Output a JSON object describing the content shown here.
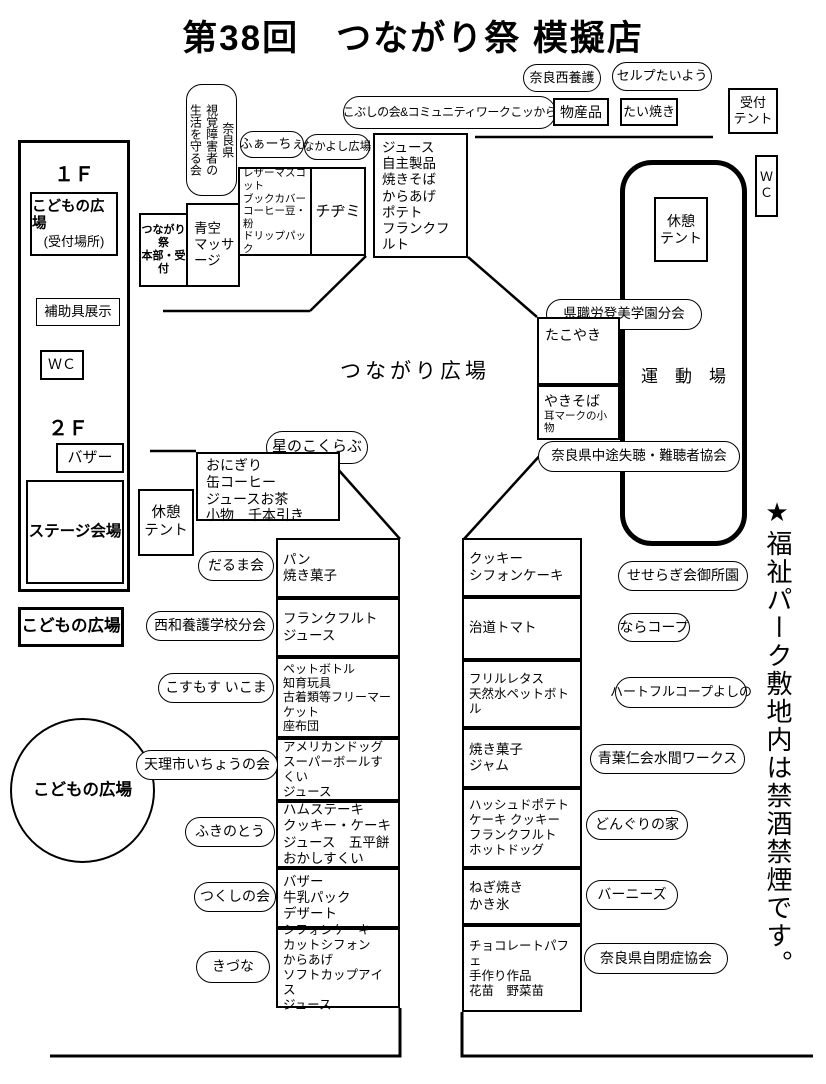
{
  "title": "第38回　つながり祭 模擬店",
  "building": {
    "floor1": "１Ｆ",
    "kids_plaza_name": "こどもの広場",
    "kids_plaza_note": "(受付場所)",
    "aids_exhibit": "補助具展示",
    "wc": "ＷＣ",
    "floor2": "２Ｆ",
    "bazaar": "バザー",
    "stage": "ステージ会場",
    "kids_plaza_outside": "こどもの広場"
  },
  "hq_area": {
    "seikatsu_mamoru_kai": [
      "奈良県",
      "視覚障害者の",
      "生活を守る会"
    ],
    "hq_reception": [
      "つながり祭",
      "本部・受付"
    ],
    "aozora_massage": [
      "青空",
      "マッサ",
      "ージ"
    ],
    "faache": "ふぁーちぇ",
    "nakayoshi_hiroba": "なかよし広場",
    "leather_booth": [
      "レザーマスコット",
      "ブックカバー",
      "コーヒー豆・粉",
      "ドリップパック"
    ],
    "chijimi": "チヂミ",
    "nakayoshi_booth": [
      "ジュース",
      "自主製品",
      "焼きそば",
      "からあげ",
      "ポテト",
      "フランクフルト"
    ]
  },
  "top_row": {
    "kobushi": "こぶしの会&コミュニティワークこッから",
    "nara_nishi_yogo": "奈良西養護",
    "bussanhin": "物産品",
    "selp_taiyo": "セルプたいよう",
    "taiyaki": "たい焼き",
    "reception_tent": [
      "受付",
      "テント"
    ],
    "wc_right": [
      "Ｗ",
      "Ｃ"
    ]
  },
  "grounds": {
    "tsunagari_hiroba": "つながり広場",
    "undojo": "運　動　場",
    "rest_tent_right": [
      "休憩",
      "テント"
    ],
    "rest_tent_left": [
      "休憩",
      "テント"
    ],
    "kenshokuro_tomi": "県職労登美学園分会",
    "takoyaki": "たこやき",
    "yakisoba": "やきそば",
    "yakisoba_sub": "耳マークの小物",
    "nanchosha_kyokai": "奈良県中途失聴・難聴者協会",
    "hoshi_no_kokurabu": "星のこくらぶ",
    "hoshi_booth": [
      "おにぎり",
      "缶コーヒー",
      "ジュースお茶",
      "小物　千本引き"
    ],
    "kids_circle": "こどもの広場",
    "notice": "★福祉パーク敷地内は禁酒禁煙です。"
  },
  "left_column": {
    "booths": [
      {
        "org": "だるま会",
        "items": [
          "パン",
          "焼き菓子"
        ]
      },
      {
        "org": "西和養護学校分会",
        "items": [
          "フランクフルト",
          "ジュース"
        ]
      },
      {
        "org": "こすもす いこま",
        "items": [
          "ペットボトル",
          "知育玩具",
          "古着類等フリーマーケット",
          "座布団"
        ]
      },
      {
        "org": "天理市いちょうの会",
        "items": [
          "アメリカンドッグ",
          "スーパーボールすくい",
          "ジュース"
        ]
      },
      {
        "org": "ふきのとう",
        "items": [
          "ハムステーキ",
          "クッキー・ケーキ",
          "ジュース　五平餅",
          "おかしすくい"
        ]
      },
      {
        "org": "つくしの会",
        "items": [
          "バザー",
          "牛乳パック",
          "デザート"
        ]
      },
      {
        "org": "きづな",
        "items": [
          "シフォンケーキ",
          "カットシフォン",
          "からあげ",
          "ソフトカップアイス",
          "ジュース"
        ]
      }
    ]
  },
  "right_column": {
    "booths": [
      {
        "org": "せせらぎ会御所園",
        "items": [
          "クッキー",
          "シフォンケーキ"
        ]
      },
      {
        "org": "ならコープ",
        "items": [
          "治道トマト"
        ]
      },
      {
        "org": "ハートフルコープよしの",
        "items": [
          "フリルレタス",
          "天然水ペットボトル"
        ]
      },
      {
        "org": "青葉仁会水間ワークス",
        "items": [
          "焼き菓子",
          "ジャム"
        ]
      },
      {
        "org": "どんぐりの家",
        "items": [
          "ハッシュドポテト",
          "ケーキ クッキー",
          "フランクフルト",
          "ホットドッグ"
        ]
      },
      {
        "org": "バーニーズ",
        "items": [
          "ねぎ焼き",
          "かき氷"
        ]
      },
      {
        "org": "奈良県自閉症協会",
        "items": [
          "チョコレートパフェ",
          "手作り作品",
          "花苗　野菜苗"
        ]
      }
    ]
  }
}
